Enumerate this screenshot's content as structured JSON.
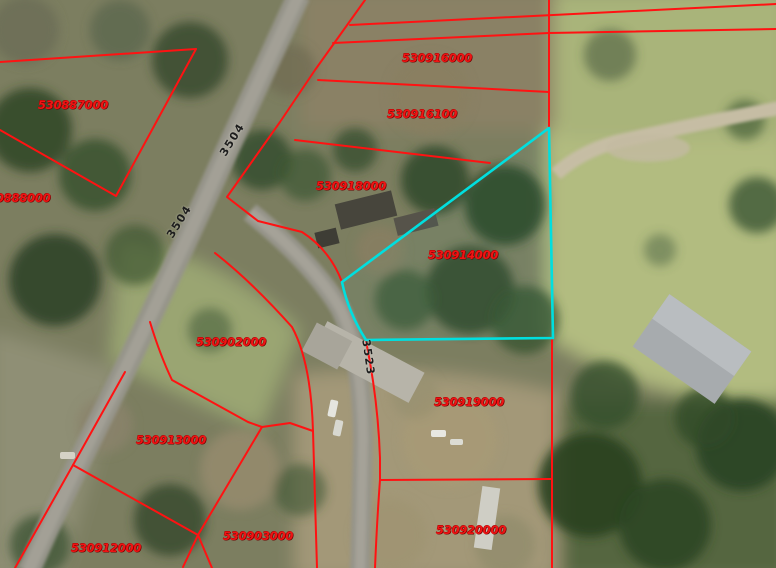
{
  "map": {
    "type": "gis-parcel-viewer-aerial",
    "boundary_color": "#ff1212",
    "highlight_color": "#00dfdf",
    "label_color": "#ef1414",
    "parcel_labels": [
      {
        "id": "530887000",
        "text": "530887000"
      },
      {
        "id": "530888000",
        "text": "0888000"
      },
      {
        "id": "530916000",
        "text": "530916000"
      },
      {
        "id": "530916100",
        "text": "530916100"
      },
      {
        "id": "530918000",
        "text": "530918000"
      },
      {
        "id": "530914000",
        "text": "530914000"
      },
      {
        "id": "530902000",
        "text": "530902000"
      },
      {
        "id": "530919000",
        "text": "530919000"
      },
      {
        "id": "530913000",
        "text": "530913000"
      },
      {
        "id": "530903000",
        "text": "530903000"
      },
      {
        "id": "530920000",
        "text": "530920000"
      },
      {
        "id": "530912000",
        "text": "530912000"
      }
    ],
    "road_labels": [
      {
        "id": "road-3504-upper",
        "text": "3504"
      },
      {
        "id": "road-3504-lower",
        "text": "3504"
      },
      {
        "id": "road-3523",
        "text": "3523"
      }
    ],
    "selected_parcel": "530914000"
  }
}
